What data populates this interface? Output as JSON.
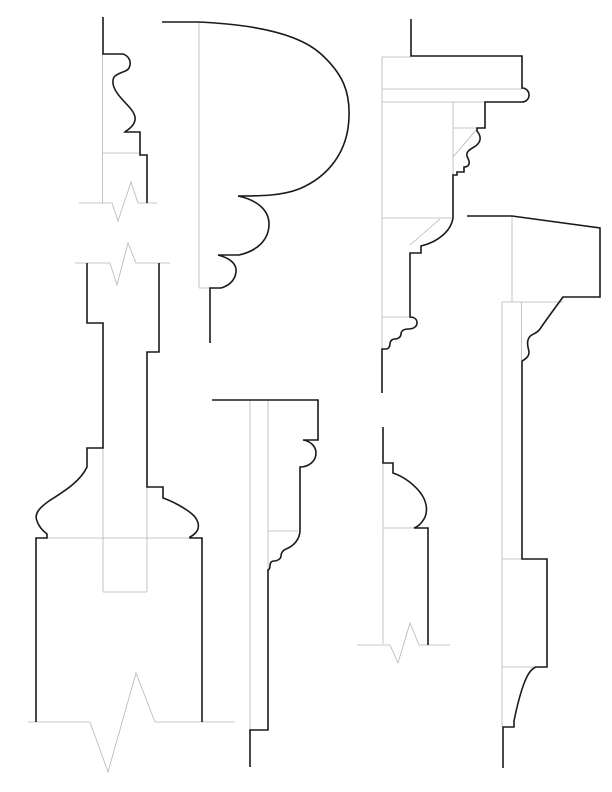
{
  "canvas": {
    "width": 612,
    "height": 792,
    "background": "#ffffff"
  },
  "colors": {
    "profile_stroke": "#1a1a1a",
    "construction_stroke": "#b5b5b5"
  },
  "figures": [
    {
      "id": "top-left-base-cap",
      "profile_path": "M 103,17 L 103,54 L 123,54 C 129,56 132,62 129,68 C 127,72 119,72 114,77 C 111,83 114,90 121,98 C 128,106 134,111 135,117 C 136,123 131,128 126,131 L 125,132 L 140,132 L 140,155 L 147,155 L 147,203",
      "construction_path": "M 102.5,54 L 102.5,203 M 102.5,153 L 140,153 M 79,203 L 112,203 L 118,221 L 131,182 L 138,203 L 157,203"
    },
    {
      "id": "top-center-torus-cap",
      "profile_path": "M 162,22 L 198,22 C 245,24 296,31 321,54 C 343,74 350,92 349,117 C 348,152 328,177 299,189 C 281,196 259,196 238,196 C 257,200 269,210 269,224 C 269,240 257,251 239,255 L 218,255 C 230,258 237,264 236,272 C 235,281 228,286 221,288 L 210,288 L 210,343",
      "construction_path": "M 199,22 L 199,288 M 199,288 L 210,288"
    },
    {
      "id": "top-right-cornice",
      "profile_path": "M 411,19 L 411,56 L 522,56 L 522,88 C 526,88 529,91 529,95 C 529,99 526,102 522,102 L 485,102 L 485,128 L 477,128 L 477,131 C 482,137 481,143 474,147 C 469,150 466,152 467,156 C 468,159 470,161 469,164 C 468,167 465,167 464,167 L 464,172 L 457,172 L 457,175 L 453,175 L 453,218 C 451,231 438,242 421,246 L 421,253 L 410,253 L 410,317 C 414,317 417,319 417,323 C 417,327 413,329 408,329 C 404,329 401,331 401,334 C 401,337 398,339 395,339 C 392,339 390,341 390,344 C 390,347 388,349 386,349 L 382,349 L 382,393",
      "construction_path": "M 382,57 L 382,350 M 382,57 L 411,57 M 382,89 L 522,89 M 382,102 L 485,102 M 453,102 L 453,175 M 453,128 L 477,128 M 453,157 L 477,129 M 382,218 L 453,218 M 410,245 L 440,219 M 382,317 L 410,317"
    },
    {
      "id": "left-baluster-with-plinth",
      "profile_path": "M 87,263 L 87,323 L 103,323 L 103,448 L 87,448 L 87,467 C 80,482 63,492 49,501 C 39,508 34,514 37,521 C 39,527 43,531 47,534 L 47,538 L 36,538 L 36,722 M 159,263 L 159,352 L 147,352 L 147,487 L 163,487 L 163,498 C 172,501 185,508 192,514 C 198,519 200,526 197,531 C 195,534 192,536 190,537 L 190,538 L 202,538 L 202,722",
      "construction_path": "M 75,263 L 110,263 L 117,285 L 128,243 L 136,263 L 170,263 M 47,538 L 190,538 M 103,448 L 103,592 M 147,487 L 147,592 M 103,592 L 147,592 M 28,722 L 90,722 L 108,772 L 136,673 L 155,722 L 235,722"
    },
    {
      "id": "center-architrave",
      "profile_path": "M 212,400 L 318,400 L 318,440 L 303,440 C 310,441 316,446 316,453 C 316,461 309,467 300,467 L 300,530 C 300,539 294,546 286,549 C 283,550 281,553 281,556 C 281,559 277,561 274,561 C 271,561 270,563 270,566 C 270,568 269,570 268,570 L 268,730 L 250,730 L 250,767",
      "construction_path": "M 250,400 L 250,730 M 268,400 L 268,570 M 268,531 L 298,531"
    },
    {
      "id": "right-panel-mold",
      "profile_path": "M 383,427 L 383,463 L 393,463 L 393,473 C 405,477 416,486 422,495 C 427,503 428,512 424,519 C 421,524 417,527 414,528 L 428,528 L 428,645",
      "construction_path": "M 383,463 L 383,644 M 383,528 L 414,528 M 357,645 L 390,645 L 398,663 L 410,623 L 419,645 L 450,645"
    },
    {
      "id": "right-tall-base-profile",
      "profile_path": "M 467,216 L 512,216 L 600,228 L 600,297 L 563,297 C 555,308 546,320 540,329 C 536,335 530,333 528,340 C 526,347 531,351 528,356 C 526,359 524,360 522,361 L 522,559 L 547,559 L 547,667 L 536,667 C 531,669 528,674 525,681 C 521,691 517,706 514,721 L 514,727 L 503,727 L 503,768",
      "construction_path": "M 512,216 L 512,302 M 502,302 L 563,302 M 502,302 L 502,727 M 521.5,302 L 521.5,360 M 502,559 L 522,559 M 502,667 L 536,667"
    }
  ]
}
